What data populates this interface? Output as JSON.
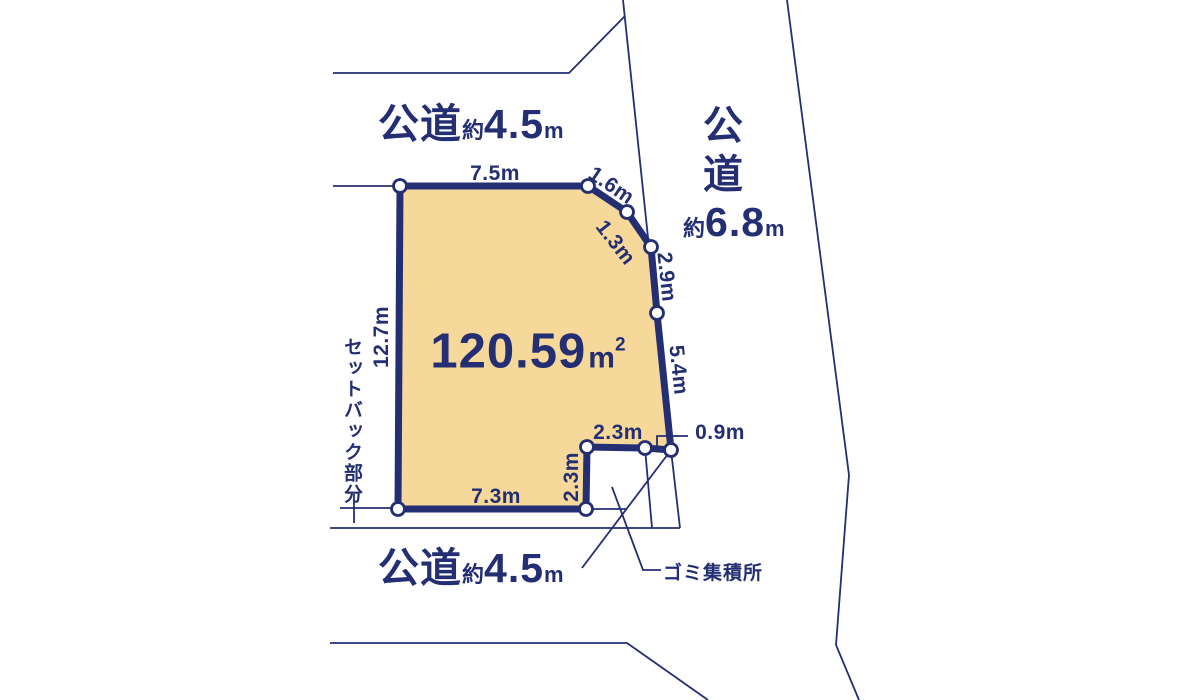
{
  "plot": {
    "area": {
      "value": "120.59",
      "unit": "m",
      "sup": "2"
    },
    "dims": {
      "top": "7.5m",
      "diag_upper": "1.6m",
      "diag_lower": "1.3m",
      "right_upper": "2.9m",
      "right_lower": "5.4m",
      "corner": "0.9m",
      "notch_top": "2.3m",
      "notch_left": "2.3m",
      "bottom": "7.3m",
      "left": "12.7m"
    },
    "setback_label": "セットバック部分",
    "garbage_label": "ゴミ集積所"
  },
  "roads": {
    "top": {
      "name": "公道",
      "approx": "約",
      "width": "4.5",
      "unit": "m"
    },
    "bottom": {
      "name": "公道",
      "approx": "約",
      "width": "4.5",
      "unit": "m"
    },
    "right": {
      "name_chars": [
        "公",
        "道"
      ],
      "approx": "約",
      "width": "6.8",
      "unit": "m"
    }
  },
  "colors": {
    "line": "#242e73",
    "text": "#242e73",
    "plot_fill": "#f6d89a",
    "vertex_fill": "#ffffff",
    "bg": "#ffffff"
  }
}
